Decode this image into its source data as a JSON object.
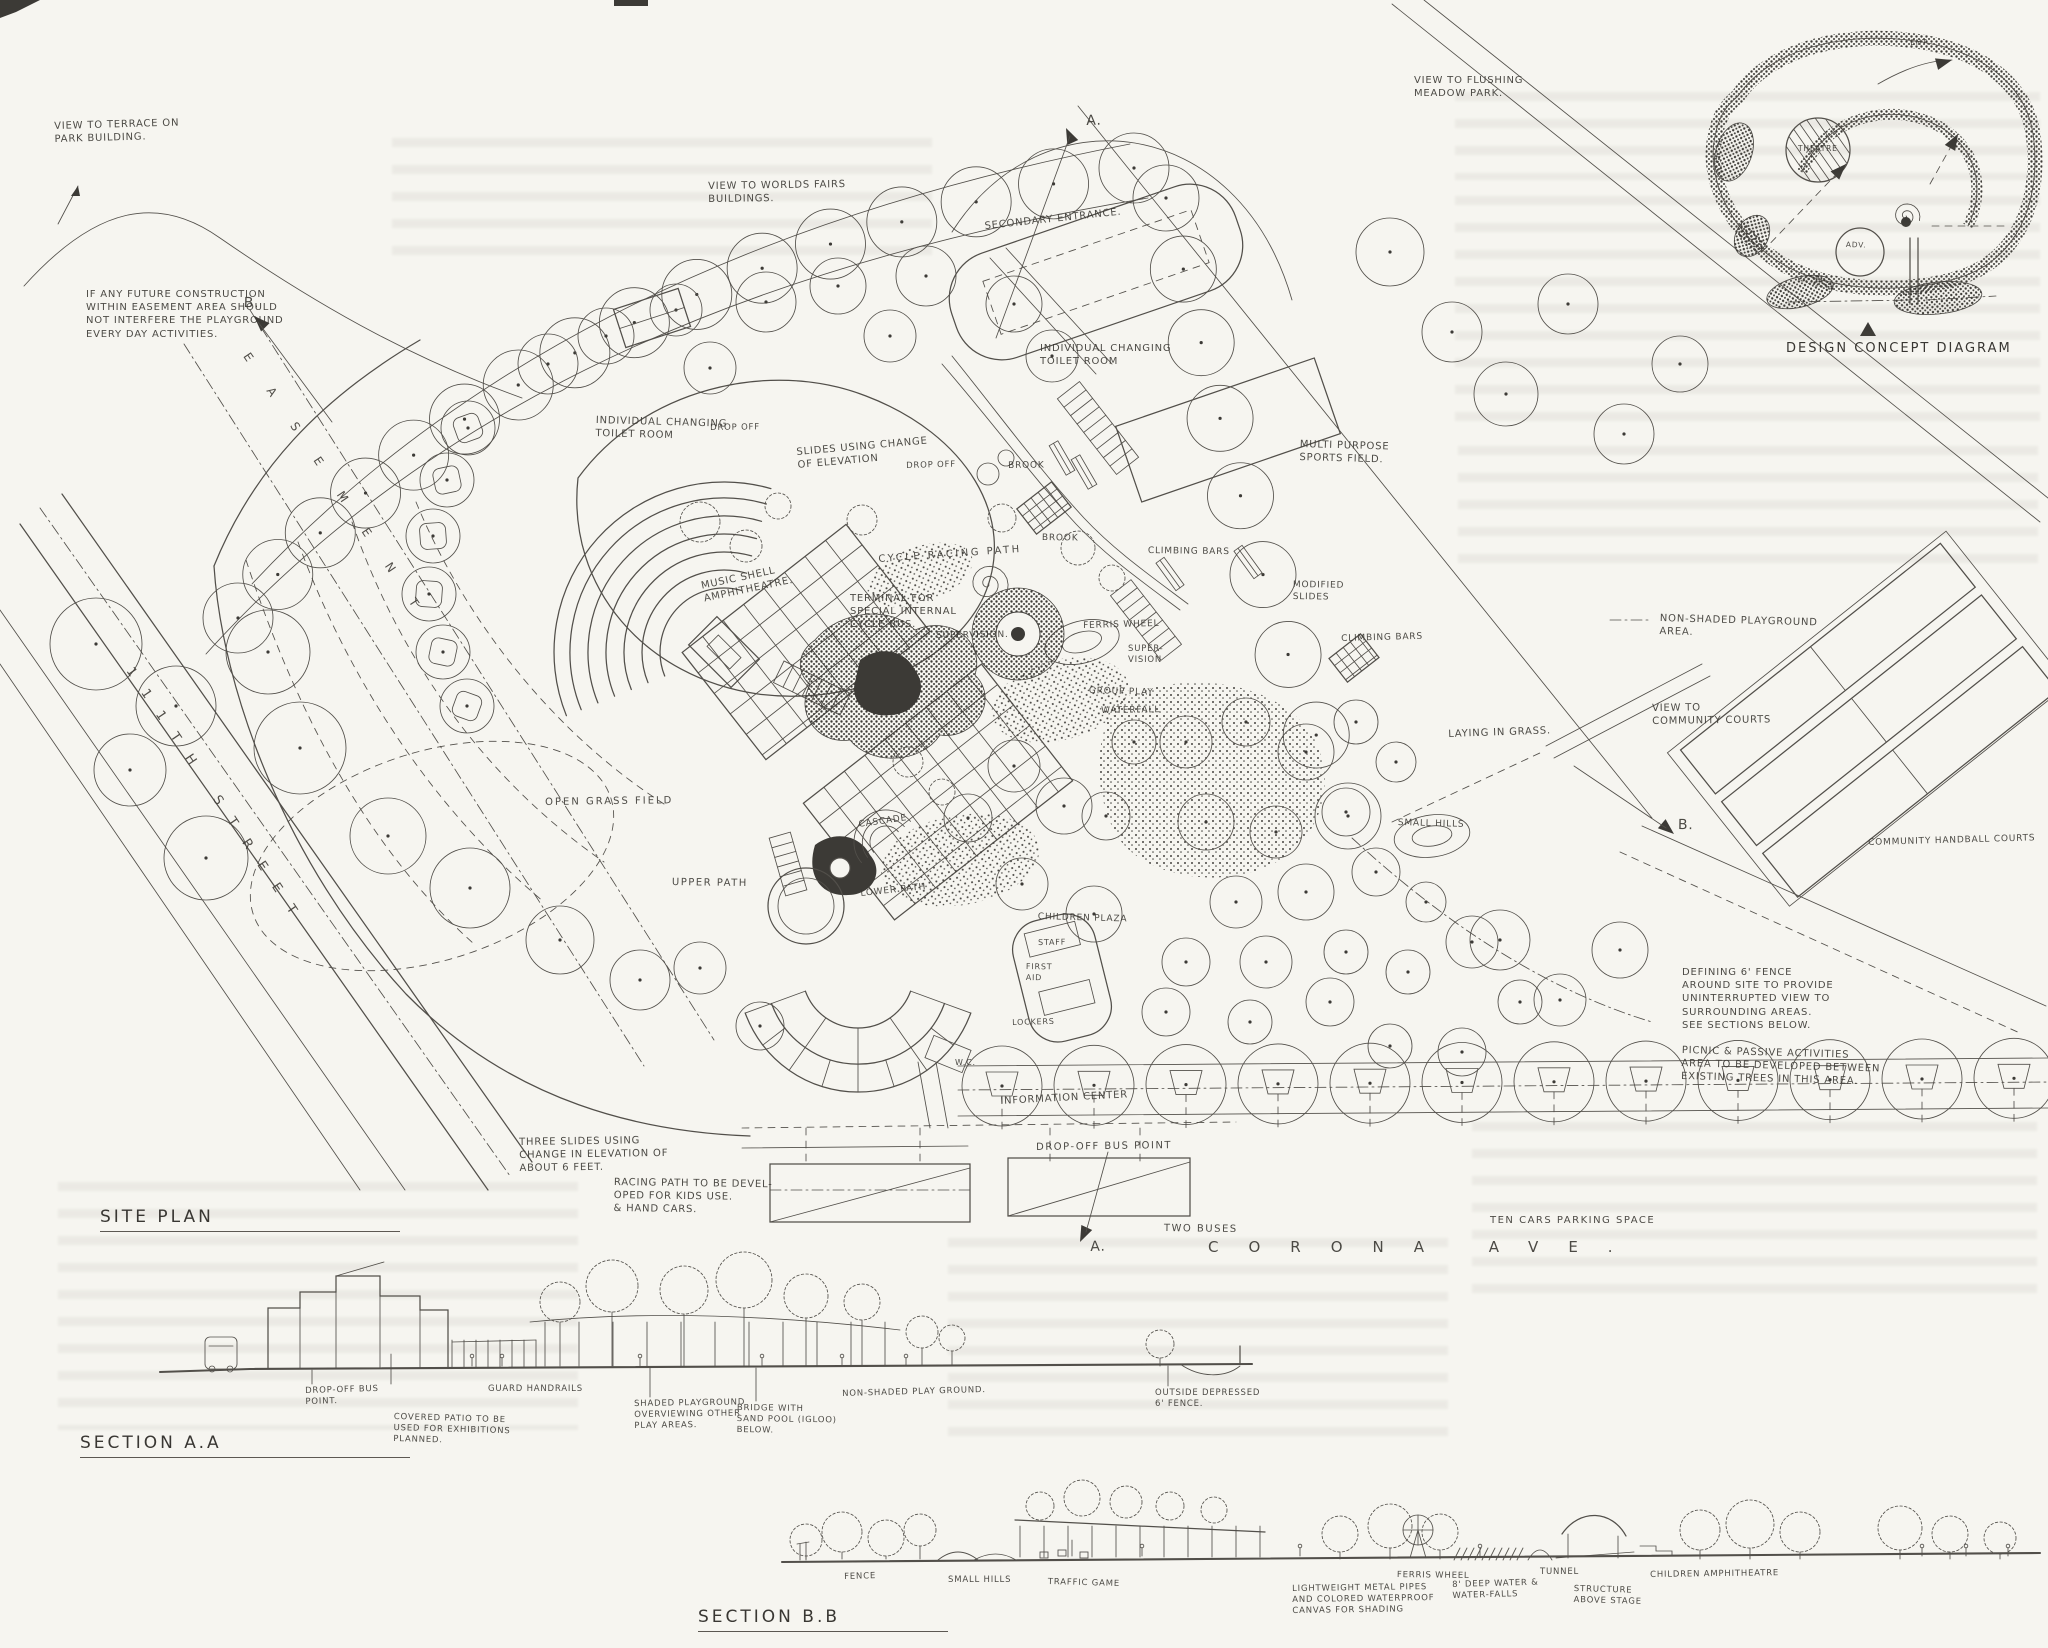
{
  "titles": {
    "site_plan": "SITE PLAN",
    "section_a": "SECTION A.A",
    "section_b": "SECTION B.B",
    "concept_diagram": "DESIGN CONCEPT DIAGRAM"
  },
  "streets": {
    "street_111": "111TH STREET",
    "easement": "EASEMENT",
    "corona": "CORONA AVE."
  },
  "palette": {
    "ink": "#4a4742",
    "paper": "#f6f5f0",
    "dark_fill": "#33312d"
  },
  "plan_labels": [
    {
      "t": "VIEW TO TERRACE ON\nPARK BUILDING.",
      "x": 54,
      "y": 120
    },
    {
      "t": "IF ANY FUTURE CONSTRUCTION\nWITHIN EASEMENT AREA SHOULD\nNOT INTERFERE THE PLAYGROUND\nEVERY DAY ACTIVITIES.",
      "x": 86,
      "y": 288
    },
    {
      "t": "B.",
      "x": 244,
      "y": 294,
      "s": 14
    },
    {
      "t": "VIEW TO WORLDS FAIRS\nBUILDINGS.",
      "x": 708,
      "y": 180
    },
    {
      "t": "SECONDARY ENTRANCE.",
      "x": 984,
      "y": 220,
      "r": -6
    },
    {
      "t": "A.",
      "x": 1086,
      "y": 112,
      "s": 14
    },
    {
      "t": "VIEW TO FLUSHING\nMEADOW PARK.",
      "x": 1414,
      "y": 74
    },
    {
      "t": "INDIVIDUAL CHANGING\nTOILET ROOM",
      "x": 596,
      "y": 414
    },
    {
      "t": "DROP OFF",
      "x": 710,
      "y": 423,
      "s": 8.5
    },
    {
      "t": "SLIDES USING CHANGE\nOF ELEVATION",
      "x": 796,
      "y": 446,
      "r": -5
    },
    {
      "t": "DROP OFF",
      "x": 906,
      "y": 461,
      "s": 8.5
    },
    {
      "t": "INDIVIDUAL CHANGING\nTOILET ROOM",
      "x": 1040,
      "y": 342
    },
    {
      "t": "MULTI PURPOSE\nSPORTS FIELD.",
      "x": 1300,
      "y": 438
    },
    {
      "t": "BROOK",
      "x": 1008,
      "y": 461,
      "s": 9
    },
    {
      "t": "BROOK",
      "x": 1042,
      "y": 533,
      "s": 9
    },
    {
      "t": "CYCLE RACING PATH",
      "x": 878,
      "y": 553,
      "r": -4,
      "ls": 2.5
    },
    {
      "t": "TERMINAL FOR\nSPECIAL INTERNAL\nCYCLE BUS.",
      "x": 850,
      "y": 592
    },
    {
      "t": "MUSIC SHELL\nAMPHITHEATRE.",
      "x": 700,
      "y": 580,
      "r": -12
    },
    {
      "t": "SUPERVISION.",
      "x": 936,
      "y": 631,
      "s": 9
    },
    {
      "t": "CLIMBING BARS",
      "x": 1148,
      "y": 546,
      "s": 9
    },
    {
      "t": "FERRIS WHEEL",
      "x": 1083,
      "y": 621,
      "s": 9
    },
    {
      "t": "SUPER-\nVISION",
      "x": 1128,
      "y": 644,
      "s": 8.5
    },
    {
      "t": "GROUP PLAY",
      "x": 1089,
      "y": 686,
      "s": 9
    },
    {
      "t": "WATERFALL",
      "x": 1101,
      "y": 706,
      "s": 9
    },
    {
      "t": "MODIFIED\nSLIDES",
      "x": 1293,
      "y": 580,
      "s": 9
    },
    {
      "t": "CLIMBING BARS",
      "x": 1341,
      "y": 634,
      "s": 9
    },
    {
      "t": "LAYING IN GRASS.",
      "x": 1448,
      "y": 728,
      "r": -2
    },
    {
      "t": "SMALL HILLS",
      "x": 1398,
      "y": 818,
      "s": 9
    },
    {
      "t": "OPEN GRASS FIELD",
      "x": 545,
      "y": 796,
      "ls": 2
    },
    {
      "t": "UPPER PATH",
      "x": 672,
      "y": 876,
      "ls": 1.5
    },
    {
      "t": "CASCADE",
      "x": 858,
      "y": 820,
      "s": 9,
      "r": -8
    },
    {
      "t": "LOWER PATH",
      "x": 860,
      "y": 889,
      "s": 9,
      "r": -6
    },
    {
      "t": "CHILDREN PLAZA",
      "x": 1038,
      "y": 912,
      "s": 9
    },
    {
      "t": "STAFF",
      "x": 1038,
      "y": 938,
      "s": 8
    },
    {
      "t": "FIRST\nAID",
      "x": 1026,
      "y": 962,
      "s": 8
    },
    {
      "t": "LOCKERS",
      "x": 1012,
      "y": 1018,
      "s": 8
    },
    {
      "t": "W.C.",
      "x": 955,
      "y": 1058,
      "s": 8
    },
    {
      "t": "INFORMATION CENTER",
      "x": 1000,
      "y": 1095,
      "r": -3
    },
    {
      "t": "DROP-OFF BUS POINT",
      "x": 1036,
      "y": 1141,
      "ls": 1.5
    },
    {
      "t": "TWO BUSES",
      "x": 1164,
      "y": 1222,
      "ls": 1.5
    },
    {
      "t": "A.",
      "x": 1090,
      "y": 1238,
      "s": 14
    },
    {
      "t": "TEN CARS PARKING SPACE",
      "x": 1490,
      "y": 1214,
      "ls": 1.5
    },
    {
      "t": "NON-SHADED PLAYGROUND\nAREA.",
      "x": 1660,
      "y": 612
    },
    {
      "t": "VIEW TO\nCOMMUNITY COURTS",
      "x": 1652,
      "y": 702
    },
    {
      "t": "B.",
      "x": 1678,
      "y": 816,
      "s": 14
    },
    {
      "t": "COMMUNITY HANDBALL COURTS",
      "x": 1868,
      "y": 838,
      "s": 9
    },
    {
      "t": "DEFINING 6' FENCE\nAROUND SITE TO PROVIDE\nUNINTERRUPTED VIEW TO\nSURROUNDING AREAS.\nSEE SECTIONS BELOW.",
      "x": 1682,
      "y": 966
    },
    {
      "t": "PICNIC & PASSIVE ACTIVITIES\nAREA TO BE DEVELOPED BETWEEN\nEXISTING TREES IN THIS AREA.",
      "x": 1682,
      "y": 1044
    },
    {
      "t": "THREE SLIDES USING\nCHANGE IN ELEVATION OF\nABOUT 6 FEET.",
      "x": 519,
      "y": 1136
    },
    {
      "t": "RACING PATH TO BE DEVEL-\nOPED FOR KIDS USE.\n& HAND CARS.",
      "x": 614,
      "y": 1176
    }
  ],
  "section_a_labels": [
    {
      "t": "DROP-OFF BUS\nPOINT.",
      "x": 305,
      "y": 1386,
      "s": 8.5
    },
    {
      "t": "GUARD HANDRAILS",
      "x": 488,
      "y": 1384,
      "s": 8.5
    },
    {
      "t": "COVERED PATIO TO BE\nUSED FOR EXHIBITIONS\nPLANNED.",
      "x": 394,
      "y": 1412,
      "s": 8.5
    },
    {
      "t": "SHADED PLAYGROUND\nOVERVIEWING OTHER\nPLAY AREAS.",
      "x": 634,
      "y": 1399,
      "s": 8.5
    },
    {
      "t": "BRIDGE WITH\nSAND POOL (IGLOO)\nBELOW.",
      "x": 737,
      "y": 1403,
      "s": 8.5
    },
    {
      "t": "NON-SHADED PLAY GROUND.",
      "x": 842,
      "y": 1389,
      "s": 8.5
    },
    {
      "t": "OUTSIDE DEPRESSED\n6' FENCE.",
      "x": 1155,
      "y": 1388,
      "s": 8.5
    }
  ],
  "section_b_labels": [
    {
      "t": "FENCE",
      "x": 844,
      "y": 1572,
      "s": 8.5
    },
    {
      "t": "SMALL HILLS",
      "x": 948,
      "y": 1575,
      "s": 8.5
    },
    {
      "t": "TRAFFIC GAME",
      "x": 1048,
      "y": 1577,
      "s": 8.5
    },
    {
      "t": "LIGHTWEIGHT METAL PIPES\nAND COLORED WATERPROOF\nCANVAS FOR SHADING",
      "x": 1292,
      "y": 1584,
      "s": 8.5
    },
    {
      "t": "FERRIS WHEEL",
      "x": 1397,
      "y": 1570,
      "s": 8.5
    },
    {
      "t": "8' DEEP WATER &\nWATER-FALLS",
      "x": 1452,
      "y": 1580,
      "s": 8.5
    },
    {
      "t": "TUNNEL",
      "x": 1540,
      "y": 1567,
      "s": 8.5
    },
    {
      "t": "STRUCTURE\nABOVE STAGE",
      "x": 1574,
      "y": 1584,
      "s": 8.5
    },
    {
      "t": "CHILDREN AMPHITHEATRE",
      "x": 1650,
      "y": 1570,
      "s": 8.5
    }
  ],
  "concept_labels": [
    {
      "t": "ENT.",
      "x": 1910,
      "y": 38,
      "s": 7.5
    },
    {
      "t": "THEATRE",
      "x": 1798,
      "y": 144,
      "s": 7.5
    },
    {
      "t": "ADV.",
      "x": 1846,
      "y": 240,
      "s": 7.5
    }
  ]
}
